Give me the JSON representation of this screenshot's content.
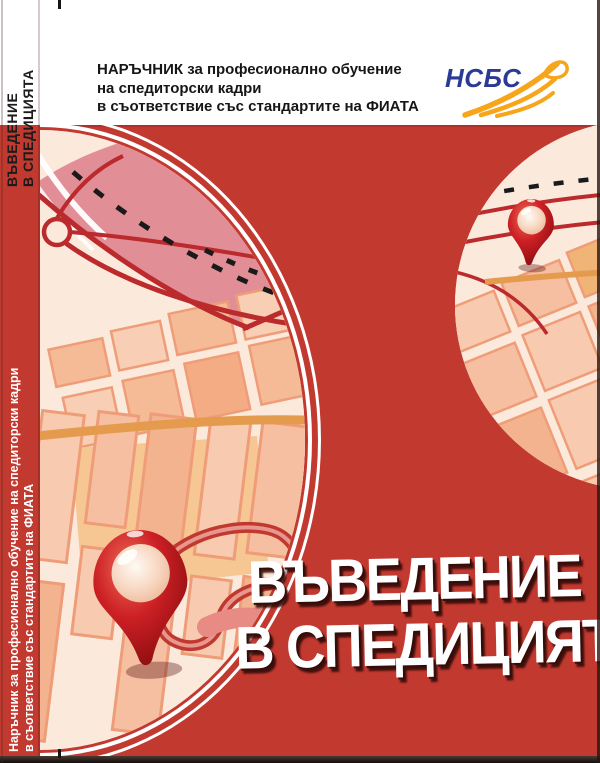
{
  "document": {
    "kind": "book-cover"
  },
  "colors": {
    "cover_red": "#c23930",
    "map_cream": "#fbe9db",
    "district_pink": "#e28e97",
    "road_red": "#bb2a2c",
    "road_orange": "#e59b4e",
    "pin_red": "#c01a1c",
    "logo_blue": "#2b3a94",
    "logo_orange": "#f7a61b",
    "title_white": "#ffffff"
  },
  "spine": {
    "title_line1": "ВЪВЕДЕНИЕ",
    "title_line2": "В СПЕДИЦИЯТА",
    "subtitle_line1": "Наръчник за професионално обучение на спедиторски кадри",
    "subtitle_line2": "в съответствие със стандартите на ФИАТА"
  },
  "header": {
    "line1": "НАРЪЧНИК за професионално обучение",
    "line2": "на спедиторски кадри",
    "line3": "в съответствие със стандартите на ФИАТА",
    "logo_text": "НСБС"
  },
  "title": {
    "line1": "ВЪВЕДЕНИЕ",
    "line2": "В СПЕДИЦИЯТА"
  }
}
